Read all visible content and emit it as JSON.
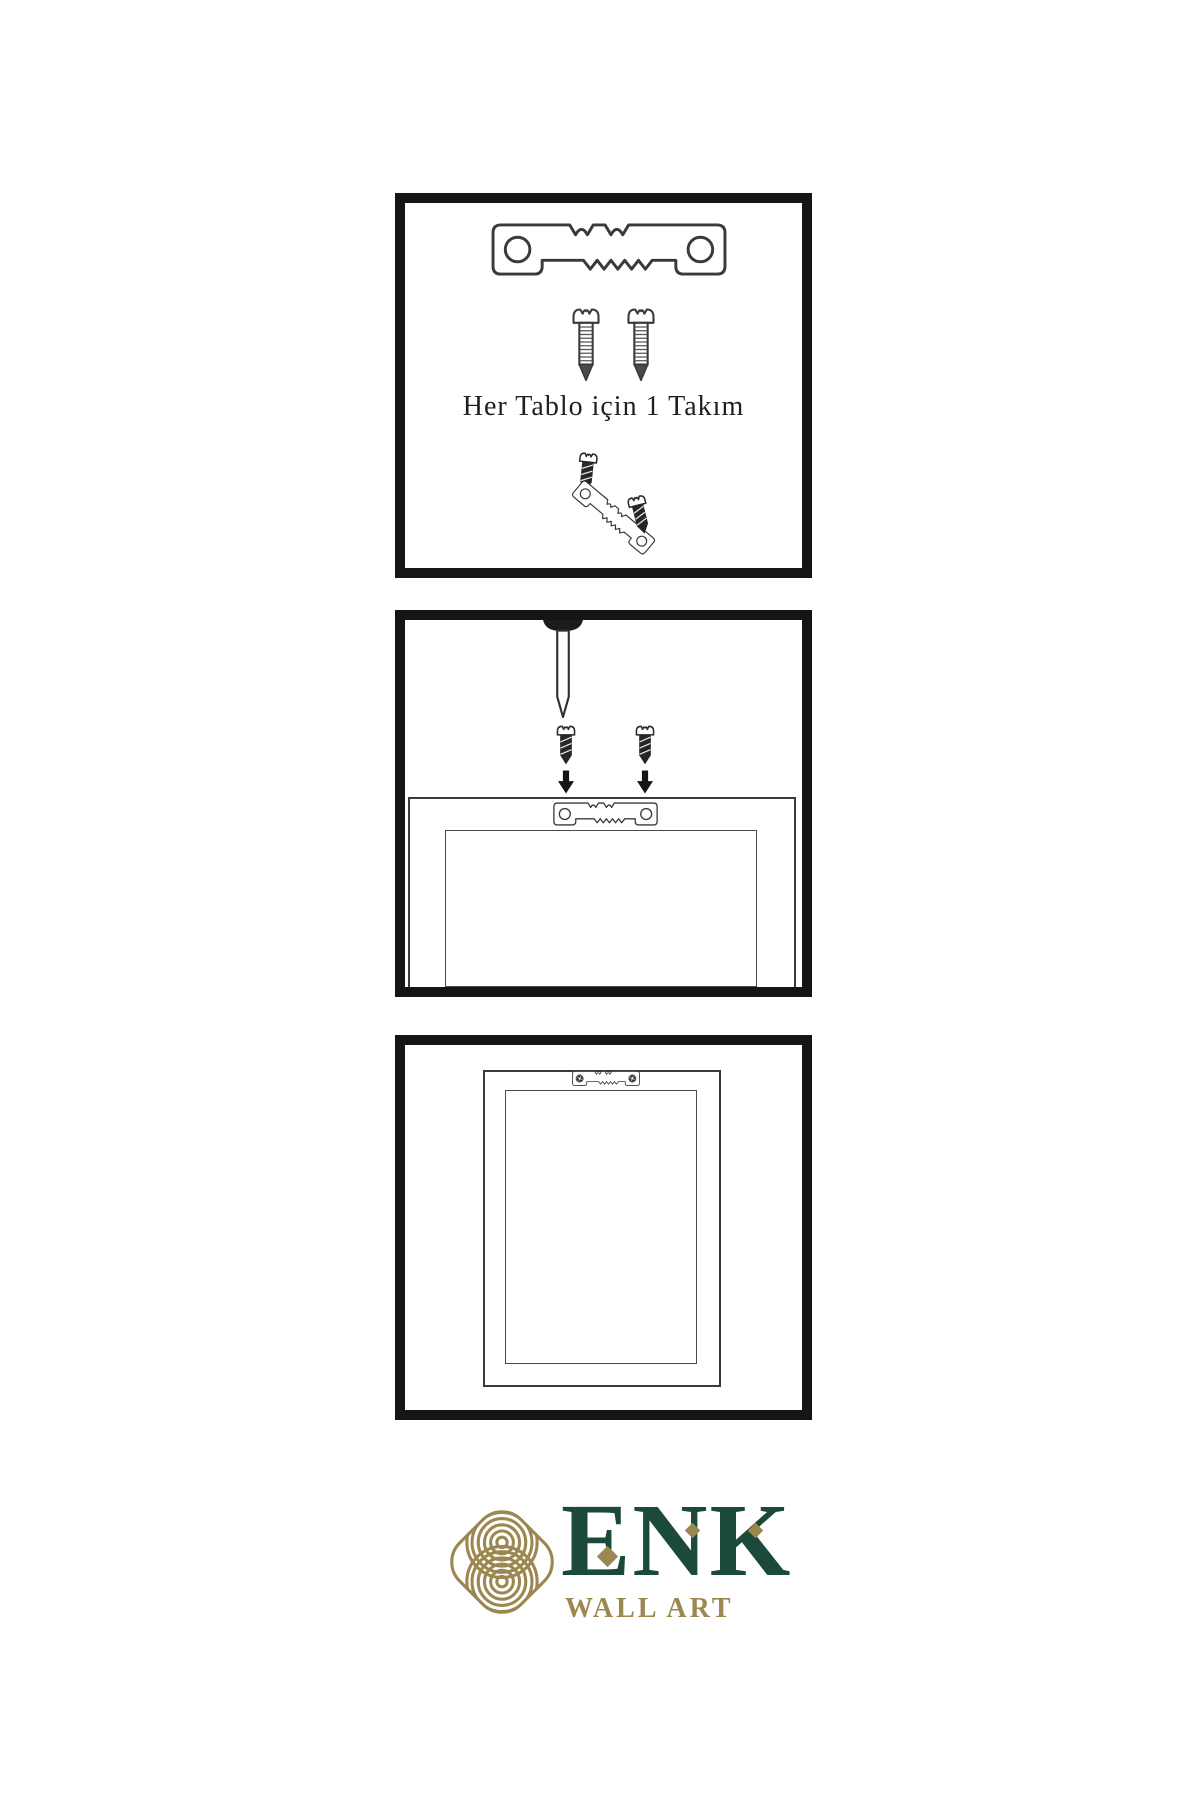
{
  "sheet": {
    "background": "#ffffff",
    "panel_border_color": "#151515",
    "line_color": "#3a3a3a"
  },
  "step_hardware": {
    "caption": "Her Tablo için 1 Takım",
    "icons": {
      "hanger": "sawtooth-hanger-icon",
      "screw_left": "screw-icon",
      "screw_right": "screw-icon",
      "assembly": "screws-into-tilted-hanger-icon"
    }
  },
  "step_wall": {
    "icons": {
      "nail": "nail-icon",
      "screw_left": "dark-screw-icon",
      "screw_right": "dark-screw-icon",
      "arrow_left": "down-arrow-icon",
      "arrow_right": "down-arrow-icon",
      "frame": "frame-back-icon",
      "hanger": "sawtooth-hanger-icon"
    }
  },
  "step_hang": {
    "icons": {
      "frame": "hanging-frame-icon",
      "hanger": "mounted-sawtooth-hanger-icon"
    }
  },
  "logo": {
    "brand": "ENK",
    "tagline": "WALL ART",
    "green": "#1c4a3a",
    "gold": "#9d8750",
    "mark": "interlaced-knot-icon"
  }
}
